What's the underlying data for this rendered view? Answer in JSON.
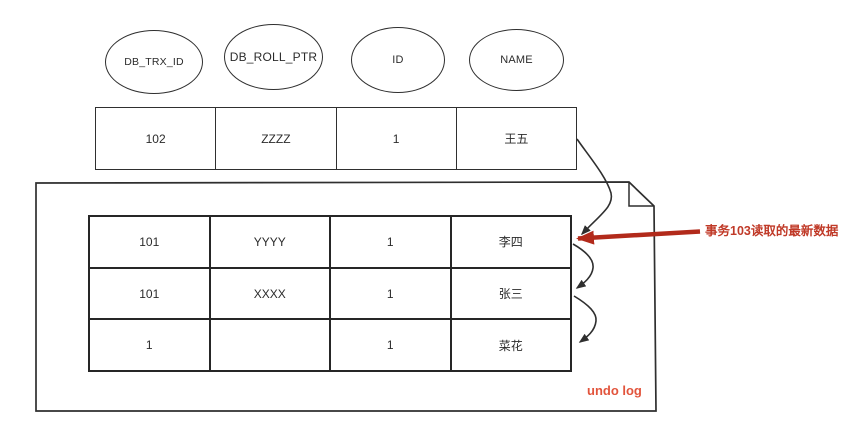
{
  "diagram": {
    "field_ellipses": [
      {
        "label": "DB_TRX_ID"
      },
      {
        "label": "DB_ROLL_PTR"
      },
      {
        "label": "ID"
      },
      {
        "label": "NAME"
      }
    ],
    "latest_row": {
      "cells": [
        "102",
        "ZZZZ",
        "1",
        "王五"
      ]
    },
    "undo_log_box": {
      "label": "undo log",
      "rows": [
        {
          "cells": [
            "101",
            "YYYY",
            "1",
            "李四"
          ]
        },
        {
          "cells": [
            "101",
            "XXXX",
            "1",
            "张三"
          ]
        },
        {
          "cells": [
            "1",
            "",
            "1",
            "菜花"
          ]
        }
      ]
    },
    "annotation": {
      "text": "事务103读取的最新数据",
      "arrow_color": "#b22a1b",
      "text_color": "#c03a28"
    },
    "undo_log_label_color": "#e2543c",
    "line_color": "#2f2f2f"
  }
}
